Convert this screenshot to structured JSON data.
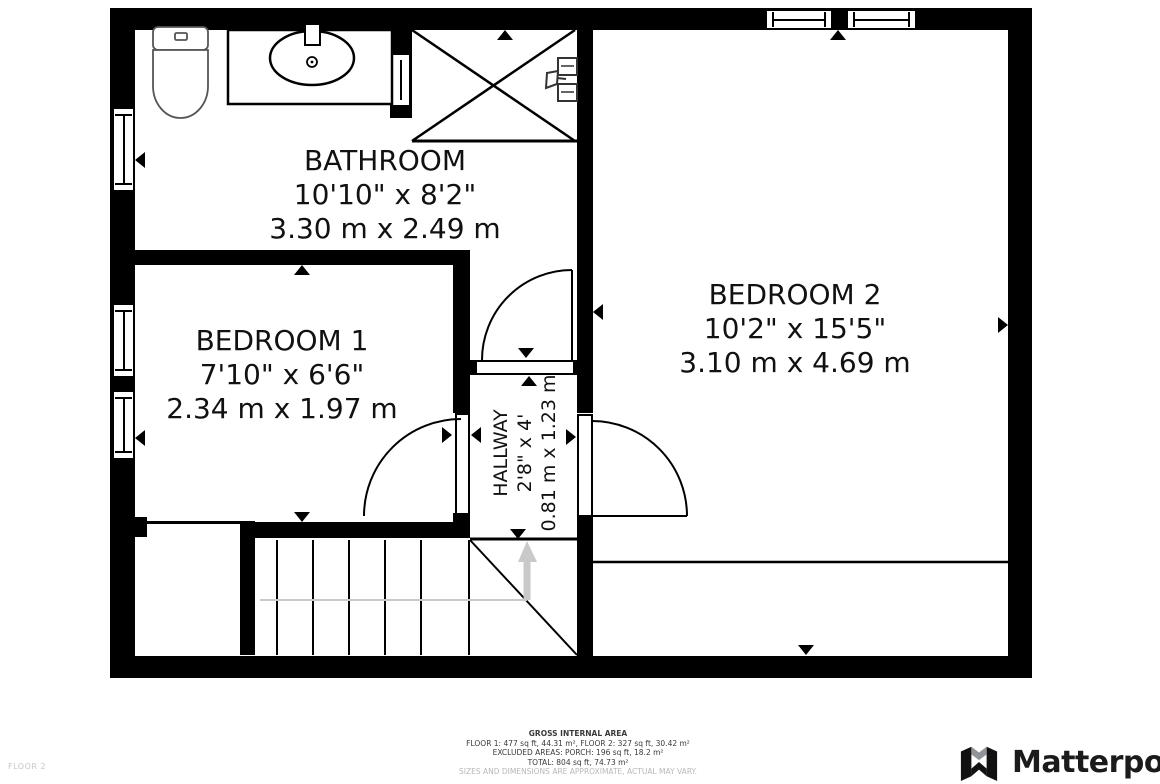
{
  "floor_label": "FLOOR 2",
  "rooms": {
    "bathroom": {
      "name": "BATHROOM",
      "imperial": "10'10\" x 8'2\"",
      "metric": "3.30 m x 2.49 m"
    },
    "bedroom1": {
      "name": "BEDROOM 1",
      "imperial": "7'10\" x 6'6\"",
      "metric": "2.34 m x 1.97 m"
    },
    "bedroom2": {
      "name": "BEDROOM 2",
      "imperial": "10'2\" x 15'5\"",
      "metric": "3.10 m x 4.69 m"
    },
    "hallway": {
      "name": "HALLWAY",
      "imperial": "2'8\" x 4'",
      "metric": "0.81 m x 1.23 m"
    }
  },
  "footer": {
    "title": "GROSS INTERNAL AREA",
    "line1": "FLOOR 1: 477 sq ft, 44.31 m², FLOOR 2: 327 sq ft, 30.42 m²",
    "line2": "EXCLUDED AREAS: PORCH: 196 sq ft, 18.2 m²",
    "line3": "TOTAL: 804 sq ft, 74.73 m²",
    "disclaimer": "SIZES AND DIMENSIONS ARE APPROXIMATE, ACTUAL MAY VARY."
  },
  "branding": {
    "logo_text": "Matterport"
  },
  "colors": {
    "wall": "#000000",
    "stair_path": "#c9c9c9",
    "text": "#111111",
    "muted": "#b8b8b8"
  }
}
